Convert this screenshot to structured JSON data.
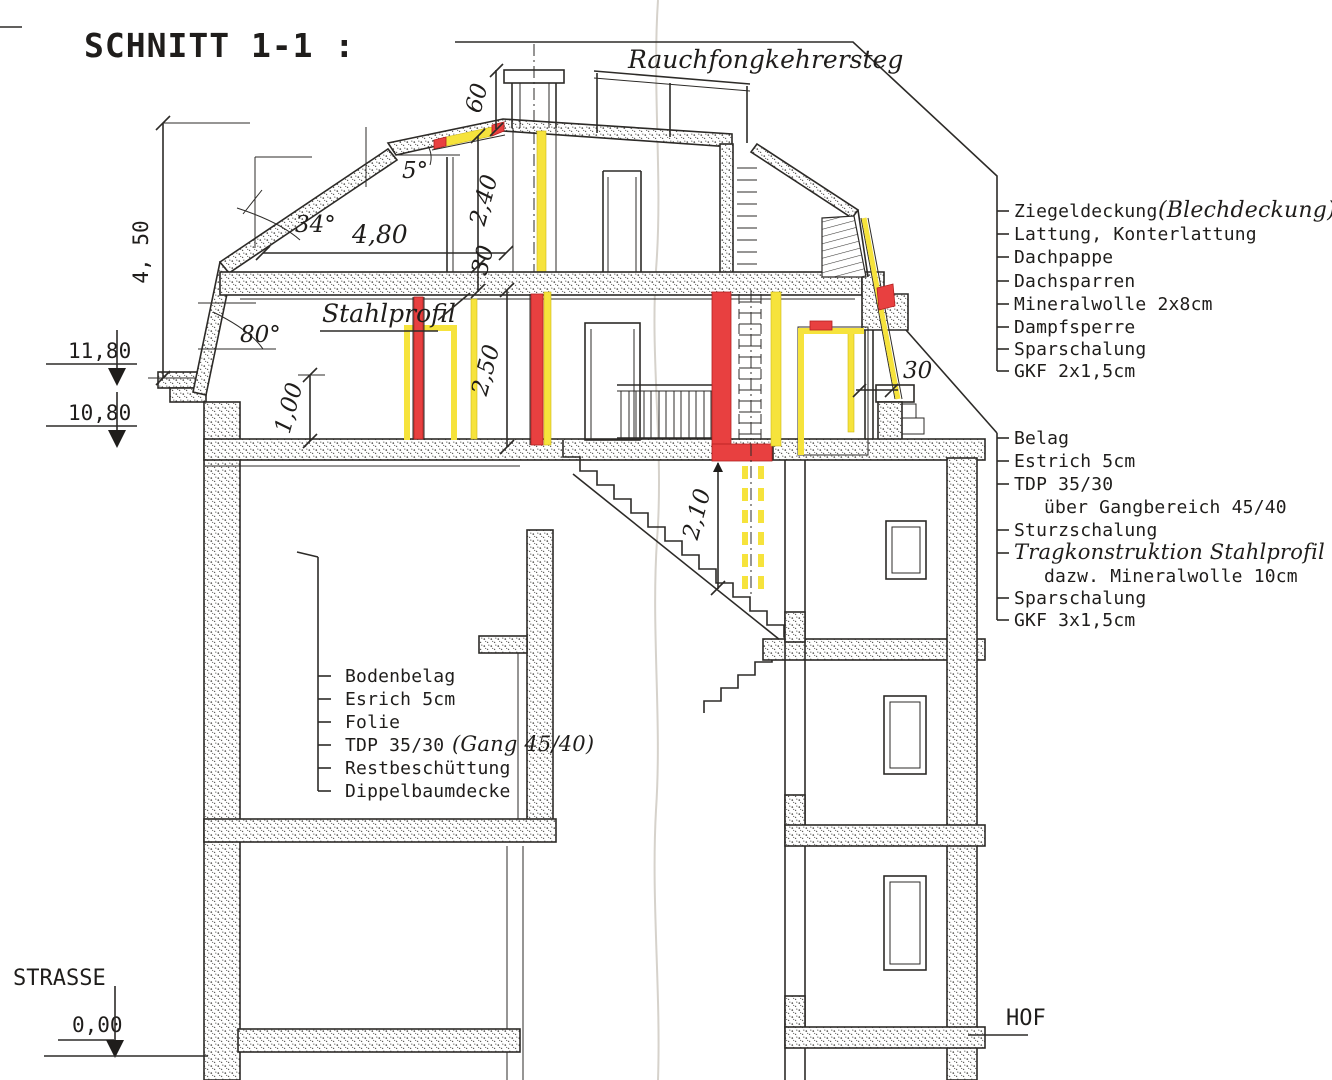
{
  "title": "SCHNITT 1-1 :",
  "labels": {
    "roof_walkway": "Rauchfongkehrersteg",
    "steel_profile": "Stahlprofil",
    "street": "STRASSE",
    "courtyard": "HOF"
  },
  "levels": {
    "eave": "11,80",
    "attic_floor": "10,80",
    "street": "0,00"
  },
  "dims": {
    "wall_height": "4, 50",
    "attic_width": "4,80",
    "upper_room_height": "2,40",
    "slab_30": "30",
    "room_height": "2,50",
    "knee_wall": "1,00",
    "headroom": "2,10",
    "chimney": "60",
    "parapet_30": "30",
    "angle_top": "5°",
    "angle_roof": "34°",
    "angle_mansard": "80°"
  },
  "roof_layers": {
    "items": [
      "Ziegeldeckung",
      "Lattung, Konterlattung",
      "Dachpappe",
      "Dachsparren",
      "Mineralwolle 2x8cm",
      "Dampfsperre",
      "Sparschalung",
      "GKF 2x1,5cm"
    ],
    "note": "(Blechdeckung)"
  },
  "ceiling_layers": {
    "items": [
      "Belag",
      "Estrich 5cm",
      "TDP 35/30",
      "über Gangbereich 45/40",
      "Sturzschalung",
      "Tragkonstruktion Stahlprofil",
      "dazw. Mineralwolle 10cm",
      "Sparschalung",
      "GKF 3x1,5cm"
    ]
  },
  "floor_layers": {
    "items": [
      "Bodenbelag",
      "Esrich 5cm",
      "Folie",
      "TDP 35/30",
      "Restbeschüttung",
      "Dippelbaumdecke"
    ],
    "note": "(Gang 45/40)"
  },
  "colors": {
    "highlight_red": "#e84040",
    "highlight_yellow": "#f6e33c",
    "line": "#2d2b28"
  }
}
